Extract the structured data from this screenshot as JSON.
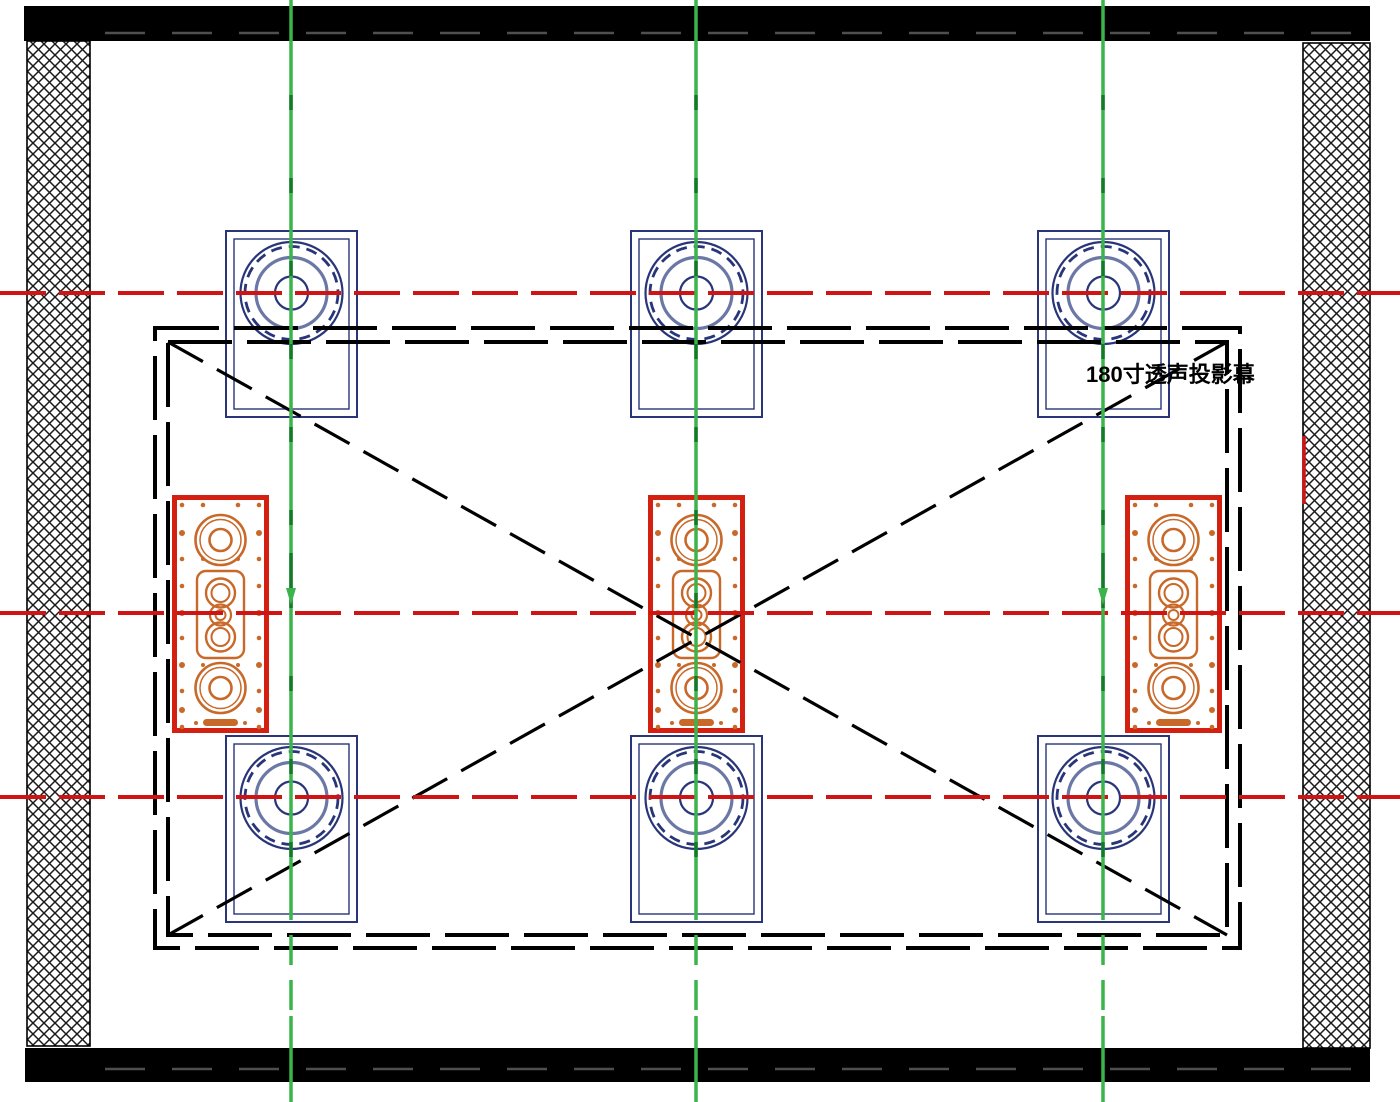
{
  "drawing": {
    "screen_label": "180寸透声投影幕"
  },
  "colors": {
    "wall_black": "#000000",
    "hatch_line": "#1a1a1a",
    "hidden_line_gray": "#4f4f4f",
    "centerline_green": "#3cb44b",
    "centerline_green_dark": "#157a28",
    "centerline_red": "#d01414",
    "lcr_border_red": "#d32011",
    "driver_orange": "#c8692a",
    "surround_blue": "#283579",
    "surround_blue_light": "#6b78a6"
  },
  "centerlines": {
    "vertical_x": [
      291,
      696,
      1103
    ],
    "vertical_arrows_x": [
      291,
      1103
    ],
    "horizontal_y": [
      293,
      613,
      797
    ]
  },
  "speakers": {
    "surround_positions": [
      {
        "x": 225,
        "y": 230
      },
      {
        "x": 630,
        "y": 230
      },
      {
        "x": 1037,
        "y": 230
      },
      {
        "x": 225,
        "y": 735
      },
      {
        "x": 630,
        "y": 735
      },
      {
        "x": 1037,
        "y": 735
      }
    ],
    "lcr_positions": [
      {
        "x": 172,
        "y": 495
      },
      {
        "x": 648,
        "y": 495
      },
      {
        "x": 1125,
        "y": 495
      }
    ]
  },
  "screen_boundary": {
    "outer": {
      "x": 155,
      "y": 328,
      "w": 1085,
      "h": 620
    },
    "inner": {
      "x": 168,
      "y": 342,
      "w": 1059,
      "h": 593
    }
  },
  "walls": {
    "top": {
      "x": 24,
      "y": 6,
      "w": 1346,
      "h": 35
    },
    "bottom": {
      "x": 25,
      "y": 1048,
      "w": 1345,
      "h": 34
    },
    "left_hatched": {
      "x": 27,
      "y": 41,
      "w": 63,
      "h": 1005
    },
    "right_hatched": {
      "x": 1303,
      "y": 43,
      "w": 67,
      "h": 1005
    },
    "red_mark": {
      "x": 1304,
      "y1": 436,
      "y2": 504
    }
  }
}
